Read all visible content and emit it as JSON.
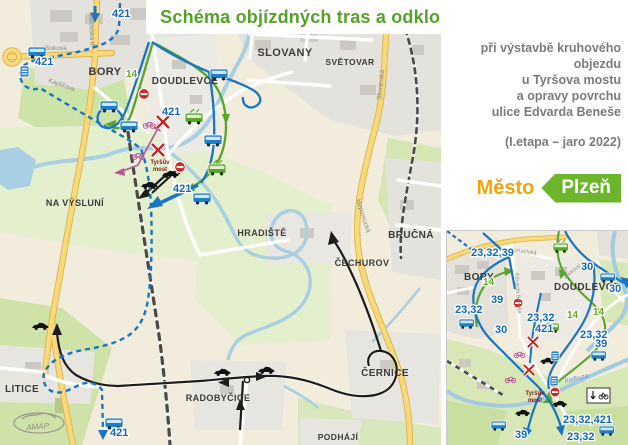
{
  "title": "Schéma objízdných tras a odklonů linek MHD a VLD",
  "subtitle": {
    "line1": "při výstavbě kruhového objezdu",
    "line2": "u Tyršova mostu",
    "line3": "a opravy povrchu",
    "line4": "ulice Edvarda Beneše",
    "etapa": "(I.etapa – jaro 2022)"
  },
  "logo": {
    "mesto": "Město",
    "plzen": "Plzeň"
  },
  "colors": {
    "title_green": "#55a228",
    "route_blue": "#1a74c4",
    "route_green": "#5aa52e",
    "closure_red": "#cc1f1f",
    "bike_pink": "#b8589c",
    "logo_orange": "#f2a50a",
    "logo_green": "#6cb52d"
  },
  "main_map": {
    "districts": {
      "bory": "BORY",
      "doudlevce": "DOUDLEVCE",
      "slovany": "SLOVANY",
      "svetovar": "SVĚTOVAR",
      "na_vysluni": "NA VÝSLUNÍ",
      "hradiste": "HRADIŠTĚ",
      "brucna": "BRUČNÁ",
      "cechurov": "ČECHUROV",
      "cernice": "ČERNICE",
      "litice": "LITICE",
      "radobycice": "RADOBYČICE",
      "podhaji": "PODHÁJÍ"
    },
    "streets": {
      "sukova": "Sukova",
      "klatovska": "Klatovská tř.",
      "kaplirova": "Kaplířova",
      "nepomucka": "Nepomucká",
      "slovanska": "Slovanská"
    },
    "badges": {
      "top": "421",
      "west": "421",
      "cancelled": "421",
      "terminus": "421",
      "south": "421",
      "line14": "14"
    },
    "bridge": {
      "line1": "Tyršův",
      "line2": "most"
    },
    "watermark": "AMAP"
  },
  "inset_map": {
    "districts": {
      "bory": "BORY",
      "doudlevce": "DOUDLEVCE"
    },
    "streets": {
      "zborovska": "Zborovská",
      "edvarda_benese": "Edvarda Beneše",
      "samaritska": "Samaritská"
    },
    "river": "Radbuza",
    "bridge": {
      "line1": "Tyršův",
      "line2": "most"
    },
    "badges": {
      "b233239": "23,32,39",
      "b14_bory": "14",
      "b39_left": "39",
      "b2332_left": "23,32",
      "b30_left": "30",
      "b2332_center": "23,32",
      "b421_center": "421",
      "b30_right1": "30",
      "b30_right2": "30",
      "b14_a": "14",
      "b14_b": "14",
      "b2332_right": "23,32",
      "b39_right": "39",
      "b2332421": "23,32,421",
      "b2332_bottom": "23,32",
      "b39_bottom": "39"
    }
  }
}
